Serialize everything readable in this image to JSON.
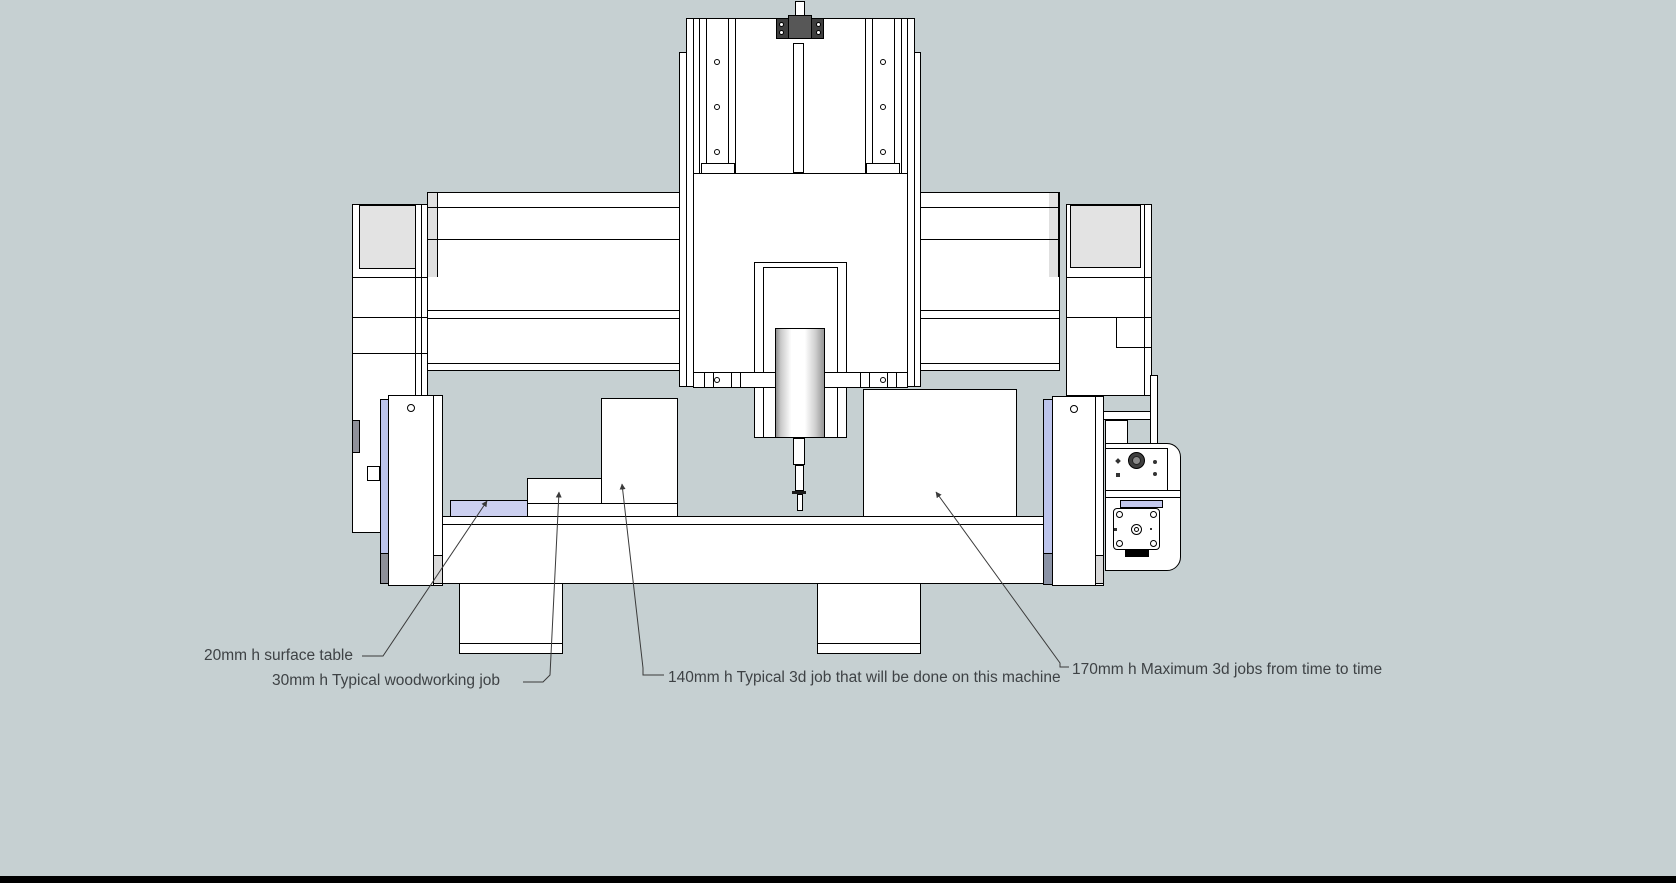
{
  "annotations": [
    {
      "label": "20mm h surface table"
    },
    {
      "label": "30mm h  Typical woodworking job"
    },
    {
      "label": "140mm h Typical 3d job that will be done on this machine"
    },
    {
      "label": "170mm h Maximum 3d jobs from time to time"
    }
  ],
  "palette": {
    "bg": "#c6d0d2",
    "inset": "#e3e3e3",
    "step": "#e0e0e0",
    "lav": "#ccd0f0",
    "plav": "#bcc4ec",
    "mlav": "#c4c9ee",
    "dkblock": "#8e9099",
    "dkblockblue": "#8b93a6",
    "ltblock": "#d9d9d9",
    "flange": "#3e3e3e",
    "mount": "#575757",
    "leader": "#3a3a3a",
    "text": "#3e4245",
    "bottombar": "#000000"
  }
}
